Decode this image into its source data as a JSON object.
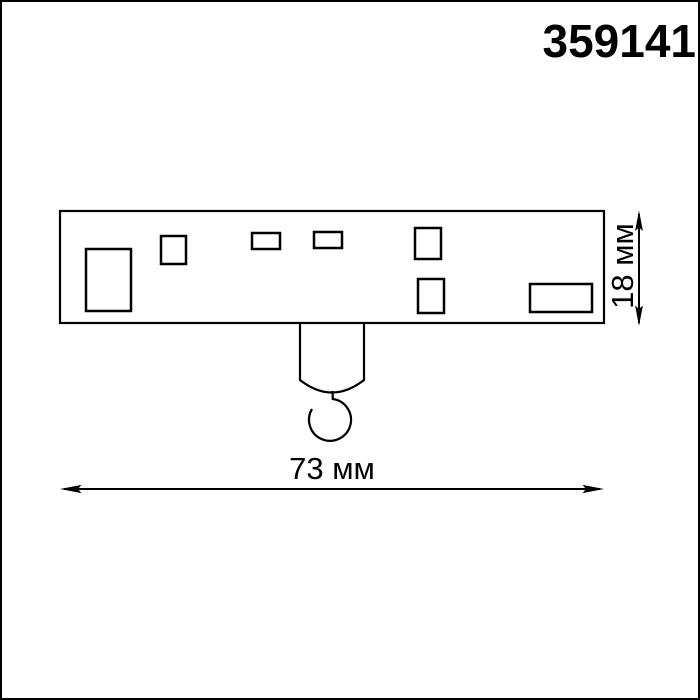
{
  "page": {
    "background_color": "#ffffff",
    "frame_color": "#000000",
    "line_color": "#000000"
  },
  "header": {
    "product_code": "359141"
  },
  "diagram": {
    "type": "technical-dimension-drawing",
    "subject": "track adapter body with suspension hook, top view",
    "width_dimension": {
      "label": "73 мм",
      "value_mm": 73
    },
    "height_dimension": {
      "label": "18 мм",
      "value_mm": 18
    }
  }
}
